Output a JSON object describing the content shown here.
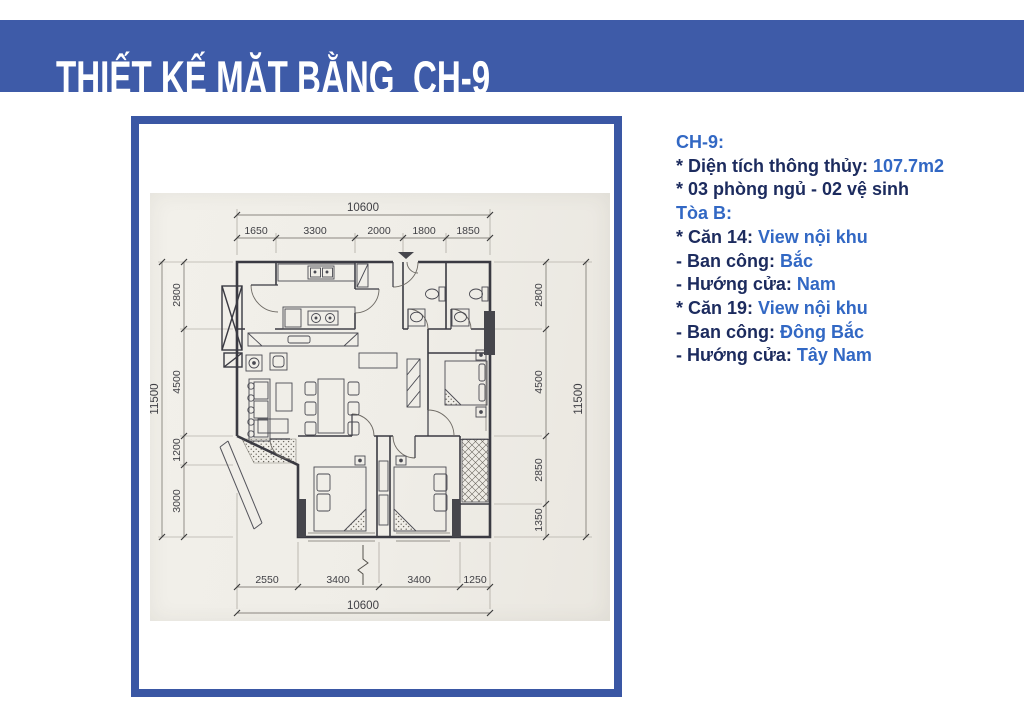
{
  "header": {
    "title": "THIẾT KẾ MẶT BẰNG  CH-9"
  },
  "colors": {
    "header_band": "#3e5ba8",
    "plan_box_border": "#3a57a4",
    "label_navy": "#1c2b5e",
    "value_blue": "#3268c4",
    "photo_paper": "#f1efe9"
  },
  "info": {
    "lines": [
      {
        "label": "CH-9:",
        "value": ""
      },
      {
        "label": "* Diện tích thông thủy: ",
        "value": "107.7m2"
      },
      {
        "label": "* 03 phòng ngủ - 02 vệ sinh",
        "value": ""
      },
      {
        "label": "Tòa B:",
        "value": ""
      },
      {
        "label": "* Căn 14: ",
        "value": "View nội khu"
      },
      {
        "label": "- Ban công: ",
        "value": "Bắc"
      },
      {
        "label": "- Hướng cửa: ",
        "value": "Nam"
      },
      {
        "label": "* Căn 19: ",
        "value": "View nội khu"
      },
      {
        "label": "- Ban công: ",
        "value": "Đông Bắc"
      },
      {
        "label": "- Hướng cửa: ",
        "value": "Tây Nam"
      }
    ]
  },
  "plan": {
    "dims": {
      "top_total": "10600",
      "top": [
        "1650",
        "3300",
        "2000",
        "1800",
        "1850"
      ],
      "bottom": [
        "2550",
        "3400",
        "3400",
        "1250"
      ],
      "bottom_total": "10600",
      "left": [
        "2800",
        "4500",
        "1200",
        "3000"
      ],
      "left_total": "11500",
      "right": [
        "2800",
        "4500",
        "2850",
        "1350"
      ],
      "right_total": "11500"
    }
  }
}
